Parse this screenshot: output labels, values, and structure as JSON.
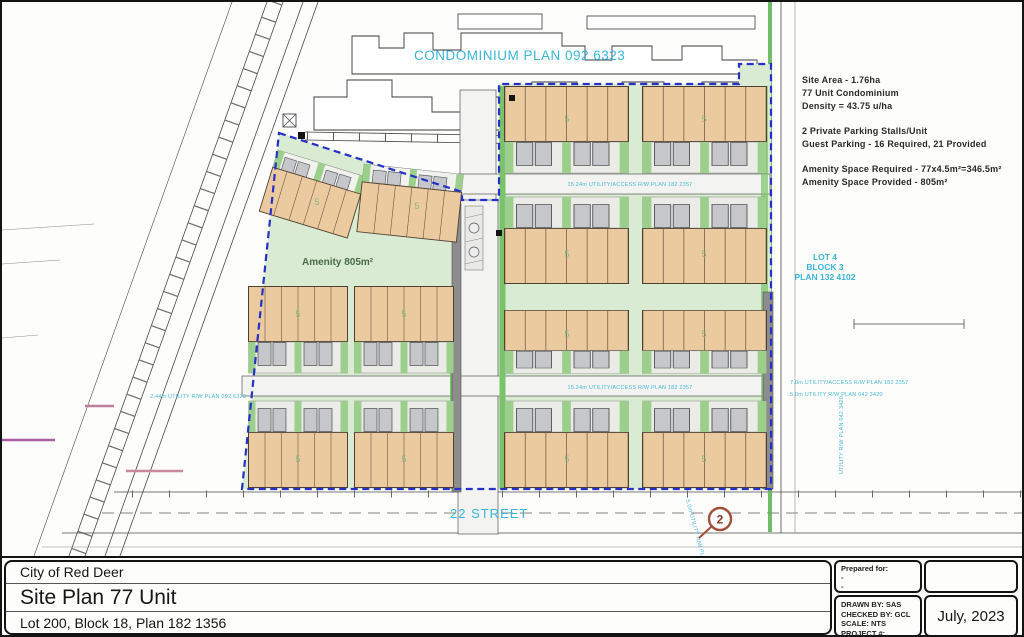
{
  "plan": {
    "condo_plan_title": "CONDOMINIUM PLAN 092 6323",
    "amenity_label": "Amenity 805m²",
    "street_label": "22 STREET",
    "unit_count_label": "5",
    "keynote": "2",
    "lot": {
      "line1": "LOT 4",
      "line2": "BLOCK 3",
      "line3": "PLAN 132 4102"
    },
    "utilities": {
      "row_access": "15.24m UTILITY/ACCESS R/W PLAN 182 2357",
      "row_util": "2.44m UTILITY R/W PLAN 092 6323",
      "right_access": "7.0m UTILITY/ACCESS R/W PLAN 182 2357",
      "right_util": "5.0m UTILITY R/W PLAN 042 3420",
      "vert_util": "UTILITY R/W PLAN 042 3420",
      "vert_util2": "5.0m UTILITY R/W PLAN 042 3420"
    }
  },
  "notes": {
    "l1": "Site Area - 1.76ha",
    "l2": "77 Unit Condominium",
    "l3": "Density = 43.75 u/ha",
    "l4": "2 Private Parking Stalls/Unit",
    "l5": "Guest Parking - 16 Required, 21 Provided",
    "l6": "Amenity Space Required - 77x4.5m²=346.5m²",
    "l7": "Amenity Space Provided - 805m²"
  },
  "title_block": {
    "municipality": "City of Red Deer",
    "title": "Site Plan 77 Unit",
    "legal": "Lot 200, Block 18, Plan 182 1356",
    "prepared_for_label": "Prepared for:",
    "prepared_dash1": "-",
    "prepared_dash2": "-",
    "drawn_by": "DRAWN BY: SAS",
    "checked_by": "CHECKED BY: GCL",
    "scale": "SCALE: NTS",
    "project": "PROJECT #: 1161109875",
    "date": "July, 2023"
  },
  "colors": {
    "boundary_blue": "#2531c6",
    "label_cyan": "#3bb5d9",
    "building_tan": "#ecca9f",
    "site_green": "#d9ebd3",
    "strip_green": "#9ccf8c",
    "road_gray": "#f3f3f1",
    "keynote_red": "#a14e38"
  }
}
